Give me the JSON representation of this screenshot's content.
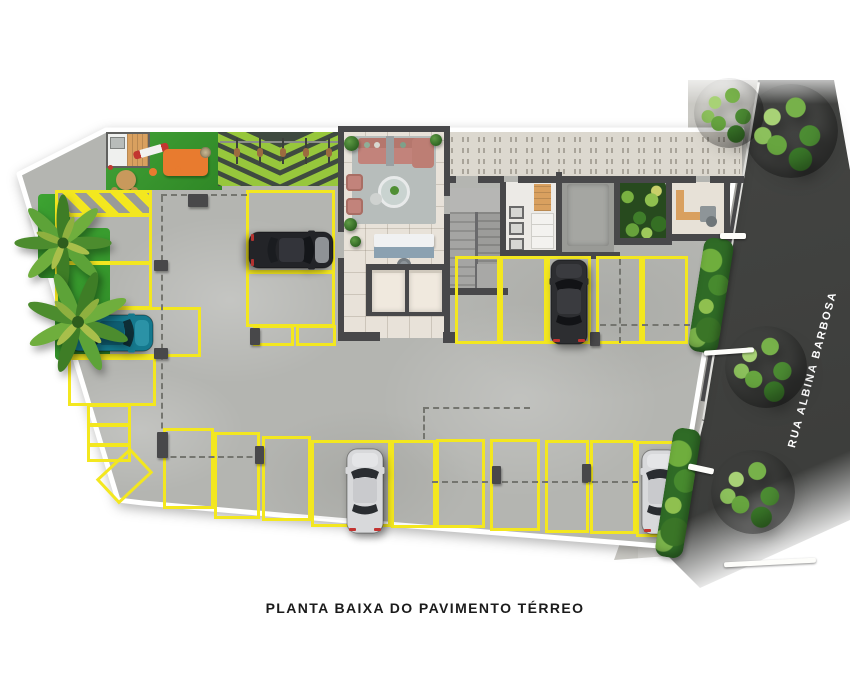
{
  "title": "PLANTA BAIXA DO PAVIMENTO TÉRREO",
  "street": {
    "name": "RUA ALBINA BARBOSA"
  },
  "scene": {
    "type": "architectural-floor-plan-illustration",
    "floor_label": "Pavimento Térreo",
    "parking_spaces_marked": 27,
    "no_parking_hatched_zones": 2,
    "bicycles_in_bike_rack": 5,
    "street_trees": 4,
    "palm_trees": 2
  },
  "cars": [
    {
      "name": "black-hatchback",
      "color": "#232428",
      "facing": "right"
    },
    {
      "name": "teal-hatchback",
      "color": "#15798e",
      "facing": "right"
    },
    {
      "name": "dark-suv",
      "color": "#2d2e31",
      "facing": "up"
    },
    {
      "name": "silver-car-bottom-center",
      "color": "#d8d9db",
      "facing": "up"
    },
    {
      "name": "silver-car-bottom-right",
      "color": "#d8d9db",
      "facing": "up"
    }
  ],
  "colors": {
    "yellow": "#f3e71f",
    "concrete": "#b4b5b1",
    "wall": "#48484a",
    "grass": "#3f9b31",
    "chevron_green": "#97c73c",
    "chevron_dark": "#3f4a40",
    "street": "#444543",
    "sidewalk": "#cac9c4",
    "paver": "#dcd8cf",
    "paver_tick": "#a9a49a",
    "lobby_floor": "#e8e2d9",
    "wood": "#d9a05f",
    "sofa": "#c2837b",
    "rug": "#b7bdbb",
    "desk": "#8ba1b1"
  }
}
